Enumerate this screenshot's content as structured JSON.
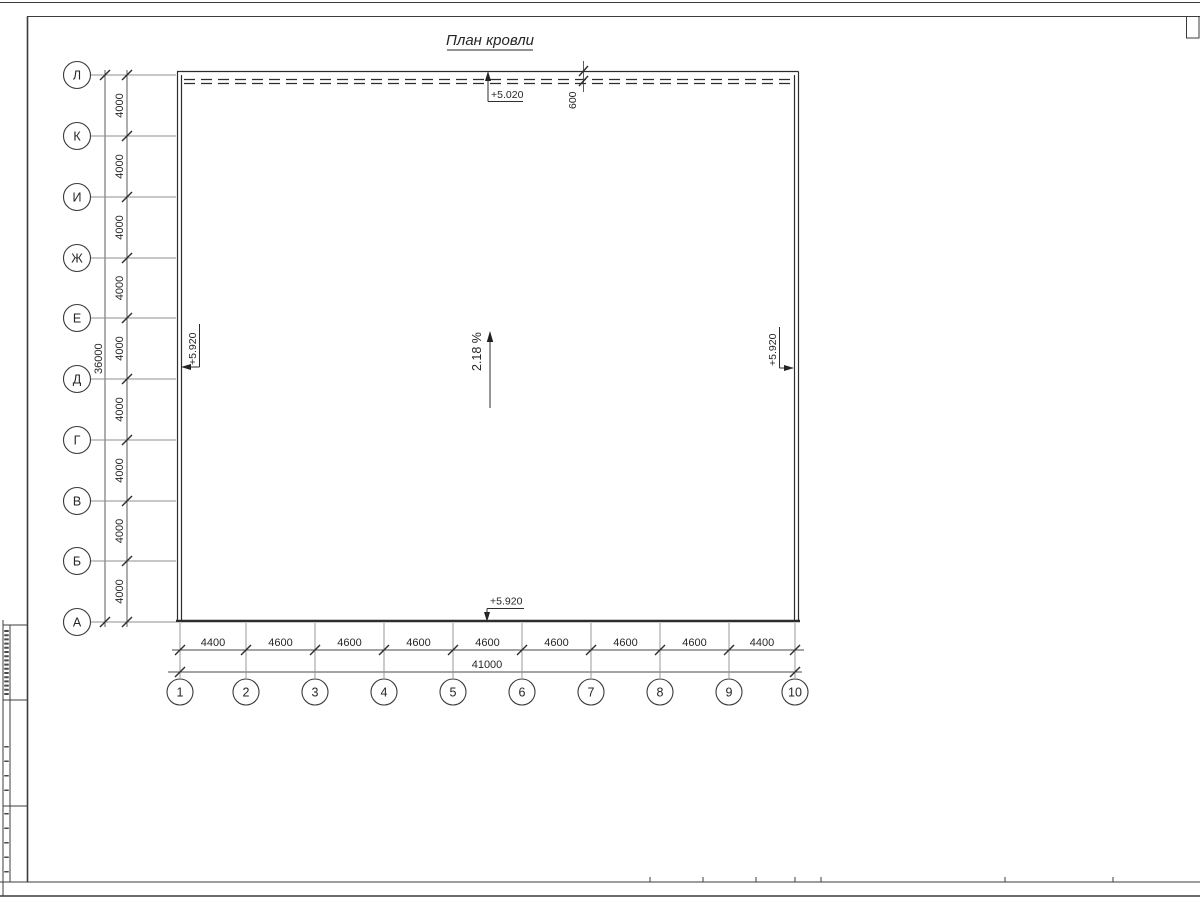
{
  "page": {
    "title": "План кровли"
  },
  "drawing": {
    "letter_axes": [
      "Л",
      "К",
      "И",
      "Ж",
      "Е",
      "Д",
      "Г",
      "В",
      "Б",
      "А"
    ],
    "number_axes": [
      "1",
      "2",
      "3",
      "4",
      "5",
      "6",
      "7",
      "8",
      "9",
      "10"
    ],
    "left_dims": {
      "segments": [
        "4000",
        "4000",
        "4000",
        "4000",
        "4000",
        "4000",
        "4000",
        "4000",
        "4000"
      ],
      "total": "36000"
    },
    "bottom_dims": {
      "segments": [
        "4400",
        "4600",
        "4600",
        "4600",
        "4600",
        "4600",
        "4600",
        "4600",
        "4400"
      ],
      "total": "41000"
    },
    "parapet_offset": "600",
    "slope_label": "2.18 %",
    "elevation_top": "+5.020",
    "elevation_left": "+5.920",
    "elevation_right": "+5.920",
    "elevation_bottom": "+5.920"
  }
}
